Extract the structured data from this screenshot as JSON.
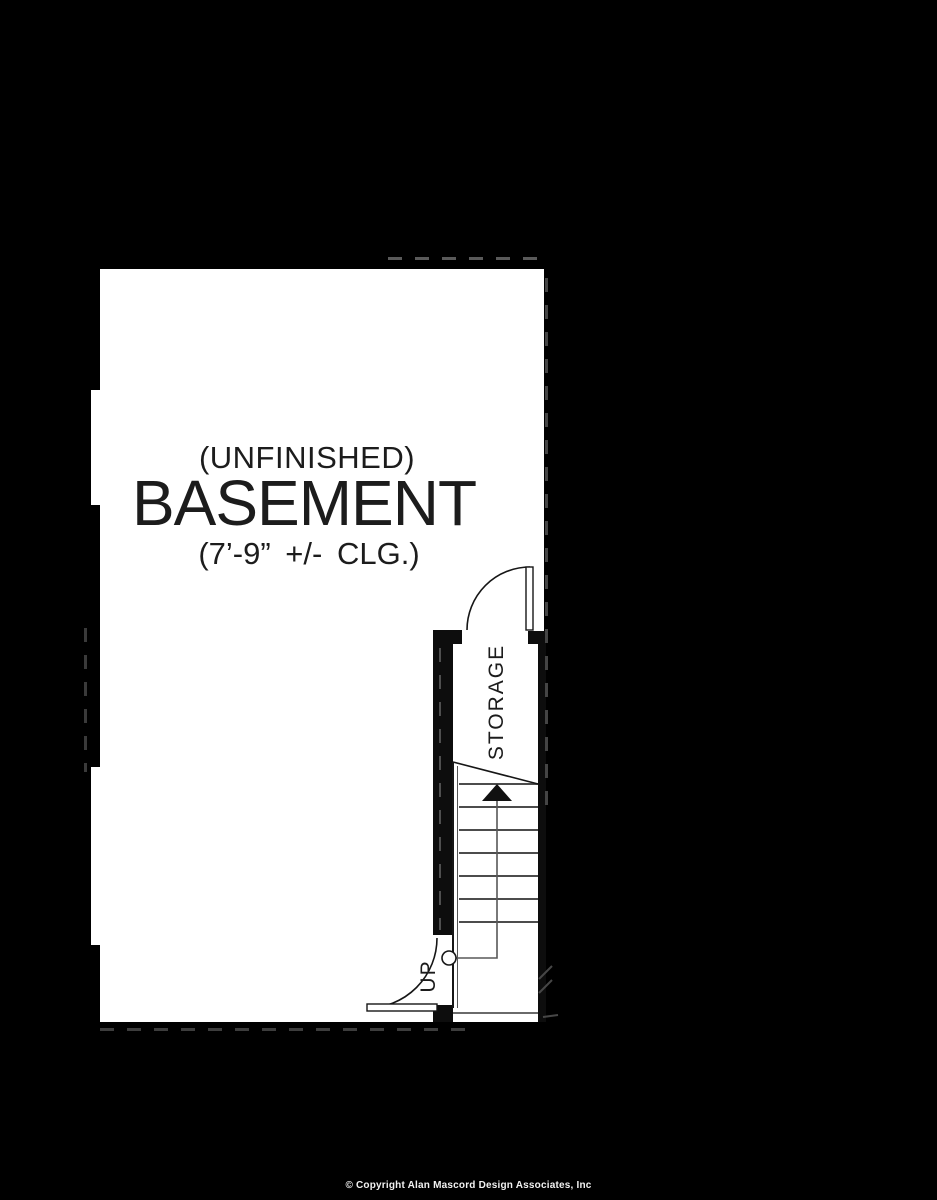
{
  "page": {
    "background": "#000000",
    "paper": "#ffffff",
    "ink": "#1c1c1c",
    "dash_gray": "#4a4a4a"
  },
  "plan": {
    "label_condition": "(UNFINISHED)",
    "label_room": "BASEMENT",
    "label_ceiling": "(7’-9” +/- CLG.)",
    "storage_label": "STORAGE",
    "stairs": {
      "up_label": "UP",
      "tread_count": 7,
      "direction": "up"
    }
  },
  "footer": {
    "copyright": "© Copyright Alan Mascord Design Associates, Inc"
  }
}
